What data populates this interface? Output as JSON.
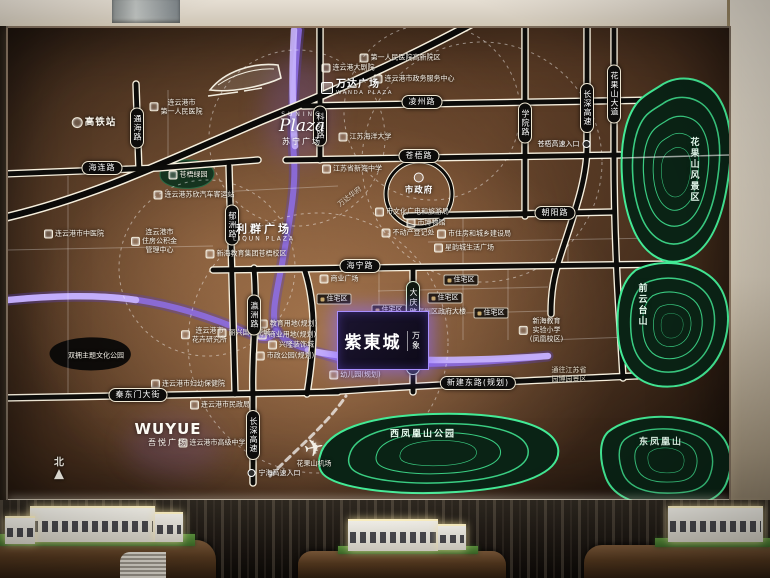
{
  "board": {
    "compass": {
      "label": "北"
    },
    "icons": {
      "airplane": "✈",
      "north_arrow": "▲"
    },
    "gov": {
      "label": "市政府"
    },
    "brands": {
      "suning": {
        "en": "SUNING",
        "script": "Plaza",
        "cn": "苏宁广场"
      },
      "wanda": {
        "cn": "万达广场",
        "en": "WANDA PLAZA"
      },
      "liqun": {
        "cn": "利群广场",
        "en": "LIQUN PLAZA"
      },
      "wuyue": {
        "en": "WUYUE",
        "cn": "吾悦广场"
      },
      "zidong": {
        "brand": "万象",
        "name": "紫東城"
      }
    },
    "road_labels_h": [
      {
        "t": "海连路",
        "x": 94,
        "y": 140
      },
      {
        "t": "凌州路",
        "x": 414,
        "y": 74
      },
      {
        "t": "苍梧路",
        "x": 411,
        "y": 128
      },
      {
        "t": "朝阳路",
        "x": 547,
        "y": 185
      },
      {
        "t": "海宁路",
        "x": 352,
        "y": 238
      },
      {
        "t": "新建东路(规划)",
        "x": 470,
        "y": 355
      },
      {
        "t": "秦东门大街",
        "x": 130,
        "y": 367
      }
    ],
    "road_labels_v": [
      {
        "t": "通海路",
        "x": 129,
        "y": 100
      },
      {
        "t": "郁洲路",
        "x": 224,
        "y": 197
      },
      {
        "t": "科苑路",
        "x": 312,
        "y": 98
      },
      {
        "t": "学院路",
        "x": 517,
        "y": 95
      },
      {
        "t": "长深高速",
        "x": 579,
        "y": 80
      },
      {
        "t": "花果山大道",
        "x": 606,
        "y": 66
      },
      {
        "t": "瀛洲路",
        "x": 246,
        "y": 287
      },
      {
        "t": "长深高速",
        "x": 245,
        "y": 407
      },
      {
        "t": "大庆路中央商务区",
        "x": 405,
        "y": 300,
        "cls": "cbd"
      }
    ],
    "landmarks": [
      {
        "t": "高铁站",
        "x": 86,
        "y": 95,
        "cls": "big"
      },
      {
        "t": "连云港市\n第一人民医院",
        "x": 168,
        "y": 79
      },
      {
        "t": "第一人民医院高新院区",
        "x": 392,
        "y": 30
      },
      {
        "t": "连云港大剧院",
        "x": 340,
        "y": 40
      },
      {
        "t": "连云港市政务服务中心",
        "x": 406,
        "y": 51
      },
      {
        "t": "江苏海洋大学",
        "x": 357,
        "y": 109
      },
      {
        "t": "江苏省新海中学",
        "x": 344,
        "y": 141
      },
      {
        "t": "连云港苏欣汽车客运站",
        "x": 186,
        "y": 167
      },
      {
        "t": "苍梧绿园",
        "x": 180,
        "y": 147
      },
      {
        "t": "连云港市中医院",
        "x": 66,
        "y": 206
      },
      {
        "t": "连云港市\n住房公积金\n管理中心",
        "x": 146,
        "y": 213
      },
      {
        "t": "新海教育集团苍梧校区",
        "x": 238,
        "y": 226
      },
      {
        "t": "万达华府",
        "x": 342,
        "y": 169,
        "cls": "diag"
      },
      {
        "t": "市文化广电和旅游局",
        "x": 404,
        "y": 184
      },
      {
        "t": "市博物馆",
        "x": 418,
        "y": 195
      },
      {
        "t": "不动产登记处",
        "x": 400,
        "y": 205
      },
      {
        "t": "市住房和城乡建设局",
        "x": 466,
        "y": 206
      },
      {
        "t": "星韵城生活广场",
        "x": 456,
        "y": 220
      },
      {
        "t": "商业广场",
        "x": 331,
        "y": 251
      },
      {
        "t": "海州区政府大楼",
        "x": 428,
        "y": 284
      },
      {
        "t": "新海教育\n实验小学\n(凤凰校区)",
        "x": 533,
        "y": 302
      },
      {
        "t": "教育用地(规划)",
        "x": 280,
        "y": 296
      },
      {
        "t": "商业用地(规划)",
        "x": 279,
        "y": 307
      },
      {
        "t": "兴隆装饰城",
        "x": 283,
        "y": 317
      },
      {
        "t": "市政公园(规划)",
        "x": 277,
        "y": 328
      },
      {
        "t": "连云港市\n花卉研究所",
        "x": 196,
        "y": 307
      },
      {
        "t": "丽兴国际花城",
        "x": 236,
        "y": 305
      },
      {
        "t": "双拥主题文化公园",
        "x": 88,
        "y": 328,
        "cls": "noic"
      },
      {
        "t": "连云港市妇幼保健院",
        "x": 180,
        "y": 356
      },
      {
        "t": "连云港市民政局",
        "x": 212,
        "y": 377
      },
      {
        "t": "连云港市高级中学",
        "x": 204,
        "y": 415
      },
      {
        "t": "幼儿园(规划)",
        "x": 347,
        "y": 347
      },
      {
        "t": "花果山机场",
        "x": 306,
        "y": 436,
        "cls": "noic"
      }
    ],
    "residential": [
      {
        "t": "住宅区",
        "x": 326,
        "y": 271
      },
      {
        "t": "住宅区",
        "x": 453,
        "y": 252
      },
      {
        "t": "住宅区",
        "x": 437,
        "y": 270
      },
      {
        "t": "住宅区",
        "x": 483,
        "y": 285
      },
      {
        "t": "住宅区",
        "x": 381,
        "y": 282
      }
    ],
    "areas": [
      {
        "t": "花果山风景区",
        "x": 686,
        "y": 142,
        "v": 1
      },
      {
        "t": "前云台山",
        "x": 634,
        "y": 277,
        "v": 1
      },
      {
        "t": "西凤凰山公园",
        "x": 415,
        "y": 405
      },
      {
        "t": "东凤凰山",
        "x": 653,
        "y": 413
      }
    ],
    "entrances": [
      {
        "t": "苍梧高速入口",
        "x": 556,
        "y": 116,
        "cls": "dot-right"
      },
      {
        "t": "宁海高速入口",
        "x": 266,
        "y": 445,
        "cls": "dot-left"
      }
    ],
    "notes": [
      {
        "t": "通往江苏省\n园博园景区",
        "x": 561,
        "y": 347
      }
    ]
  },
  "colors": {
    "board_bronze": "#4c311f",
    "road_black": "#0d0c0a",
    "road_casing": "#f6efdd",
    "river_purple": "#8e6fe8",
    "contour_green": "#2ecf82",
    "highlight_purple": "#a98fff",
    "wall_beige": "#d5ccbd"
  }
}
